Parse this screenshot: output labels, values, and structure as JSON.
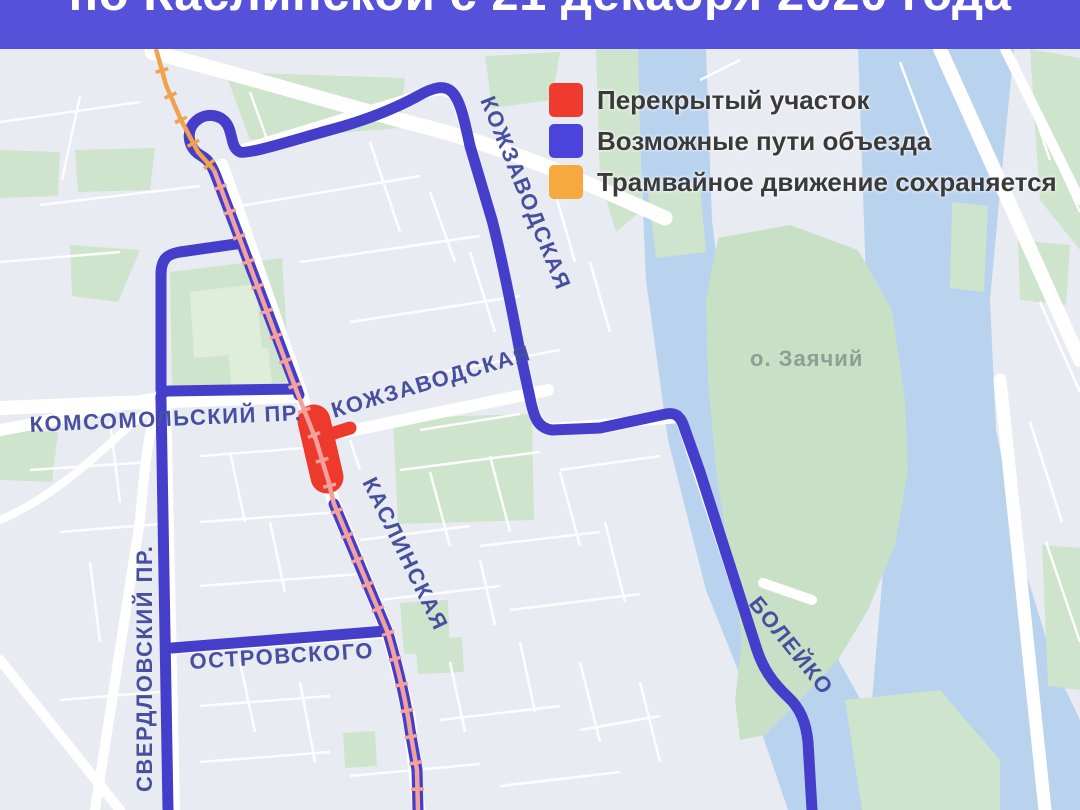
{
  "header": {
    "title": "по Каслинской с 21 декабря 2020 года",
    "bg": "#5551d9"
  },
  "legend": {
    "items": [
      {
        "label": "Перекрытый участок",
        "color": "#ef3b2e"
      },
      {
        "label": "Возможные пути объезда",
        "color": "#4b44dc"
      },
      {
        "label": "Трамвайное движение сохраняется",
        "color": "#f5a93e"
      }
    ]
  },
  "map": {
    "street_labels": {
      "kozhzavodskaya_north": "КОЖЗАВОДСКАЯ",
      "kozhzavodskaya_mid": "КОЖЗАВОДСКАЯ",
      "komsomolsky": "КОМСОМОЛЬСКИЙ ПР.",
      "sverdlovsky": "СВЕРДЛОВСКИЙ ПР.",
      "ostrovskogo": "ОСТРОВСКОГО",
      "kaslinskaya": "КАСЛИНСКАЯ",
      "boleyko": "БОЛЕЙКО"
    },
    "place_labels": {
      "zayachiy_island": "о. Заячий"
    },
    "colors": {
      "background": "#e9ebf3",
      "water": "#b9d2ee",
      "park": "#cfe4cc",
      "road": "#ffffff",
      "detour_route": "#443ecb",
      "closed_section": "#ee3a2c",
      "tram_solo": "#f0a24e",
      "tram_over_route": "#f2a19c"
    }
  }
}
